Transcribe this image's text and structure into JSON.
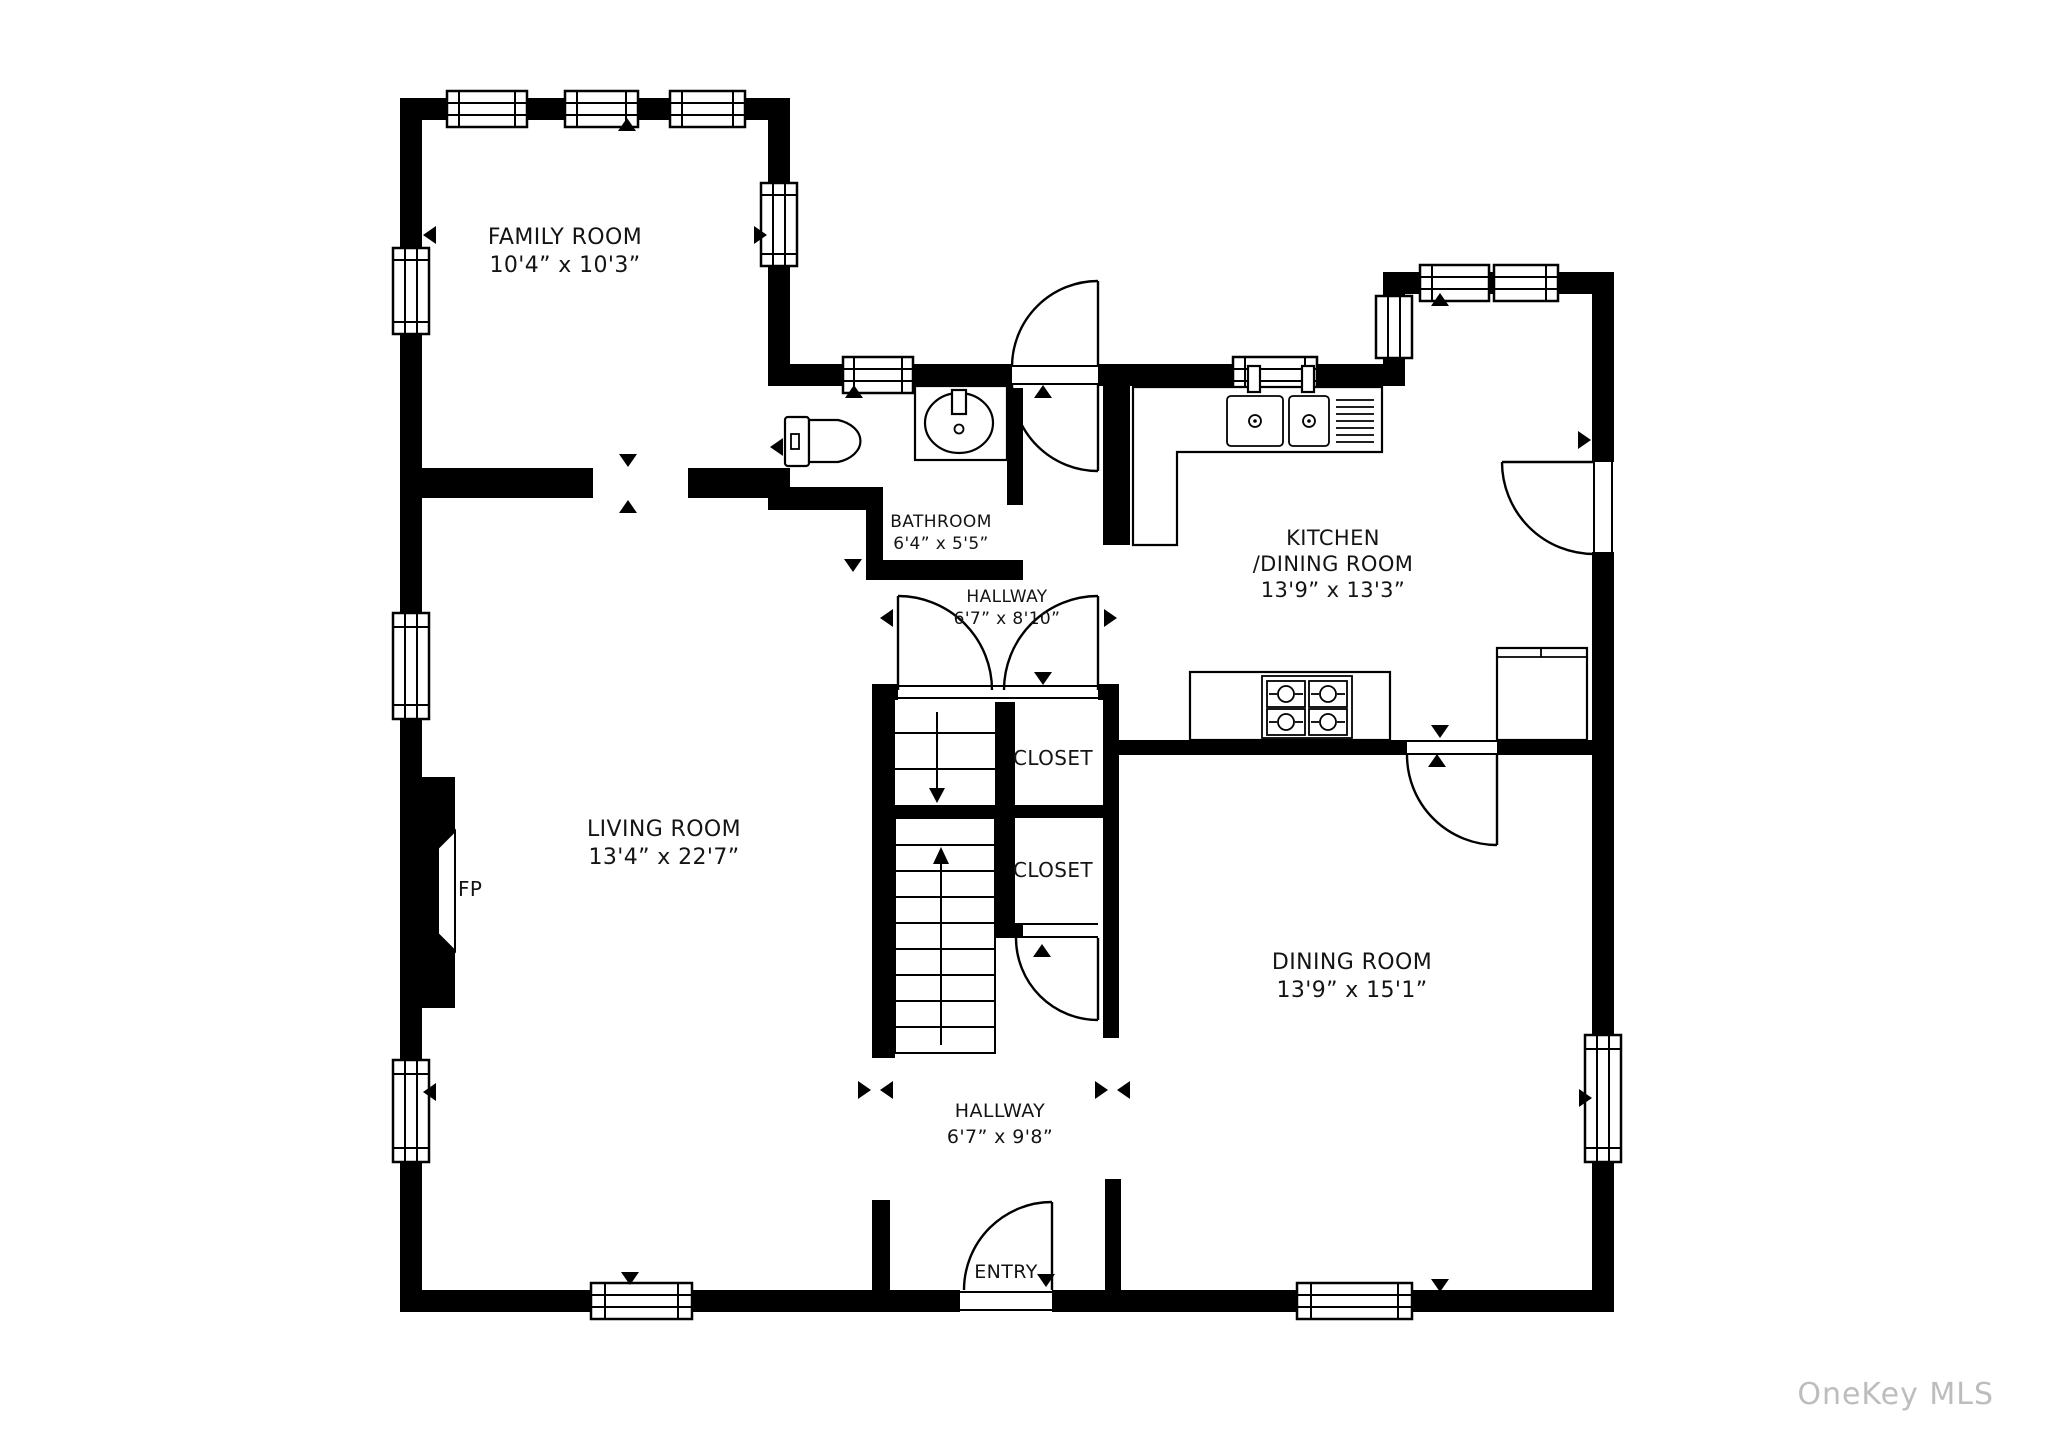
{
  "watermark": "OneKey MLS",
  "colors": {
    "wall": "#000000",
    "background": "#ffffff",
    "watermark": "#bdbdbd",
    "text": "#141414"
  },
  "rooms": [
    {
      "id": "family-room",
      "name": "FAMILY ROOM",
      "dims": "10'4” x 10'3”"
    },
    {
      "id": "bathroom",
      "name": "BATHROOM",
      "dims": "6'4” x 5'5”"
    },
    {
      "id": "hallway-upper",
      "name": "HALLWAY",
      "dims": "6'7” x 8'10”"
    },
    {
      "id": "kitchen",
      "name": "KITCHEN",
      "name2": "/DINING ROOM",
      "dims": "13'9” x 13'3”"
    },
    {
      "id": "closet-upper",
      "name": "CLOSET"
    },
    {
      "id": "closet-lower",
      "name": "CLOSET"
    },
    {
      "id": "living-room",
      "name": "LIVING ROOM",
      "dims": "13'4” x 22'7”"
    },
    {
      "id": "dining-room",
      "name": "DINING ROOM",
      "dims": "13'9” x 15'1”"
    },
    {
      "id": "hallway-lower",
      "name": "HALLWAY",
      "dims": "6'7” x 9'8”"
    },
    {
      "id": "entry",
      "name": "ENTRY"
    },
    {
      "id": "fireplace",
      "name": "FP"
    }
  ]
}
